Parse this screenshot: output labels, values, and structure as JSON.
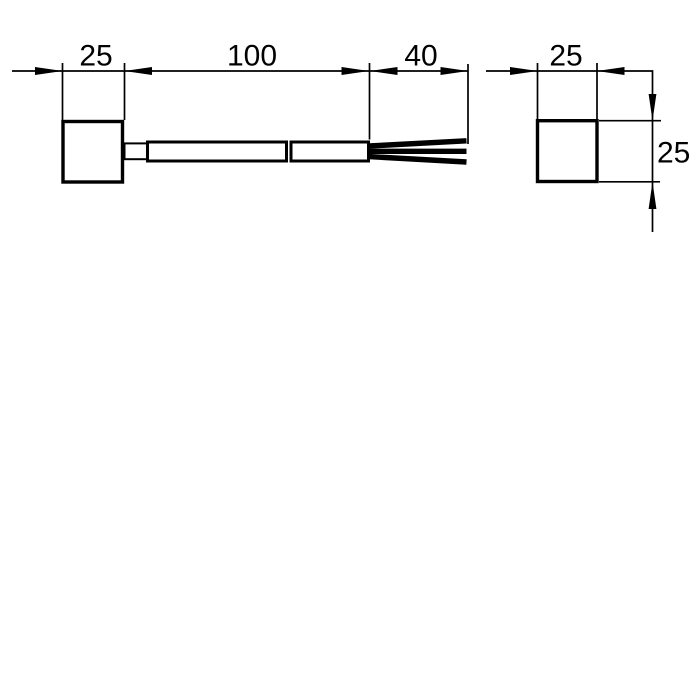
{
  "drawing": {
    "title": "sensor-with-cable-dimensional-drawing",
    "colors": {
      "line": "#000000",
      "background": "#ffffff"
    },
    "front_view": {
      "body_width_label": "25",
      "cable_length_label": "100",
      "wire_length_label": "40"
    },
    "side_view": {
      "width_label": "25",
      "height_label": "25"
    }
  }
}
